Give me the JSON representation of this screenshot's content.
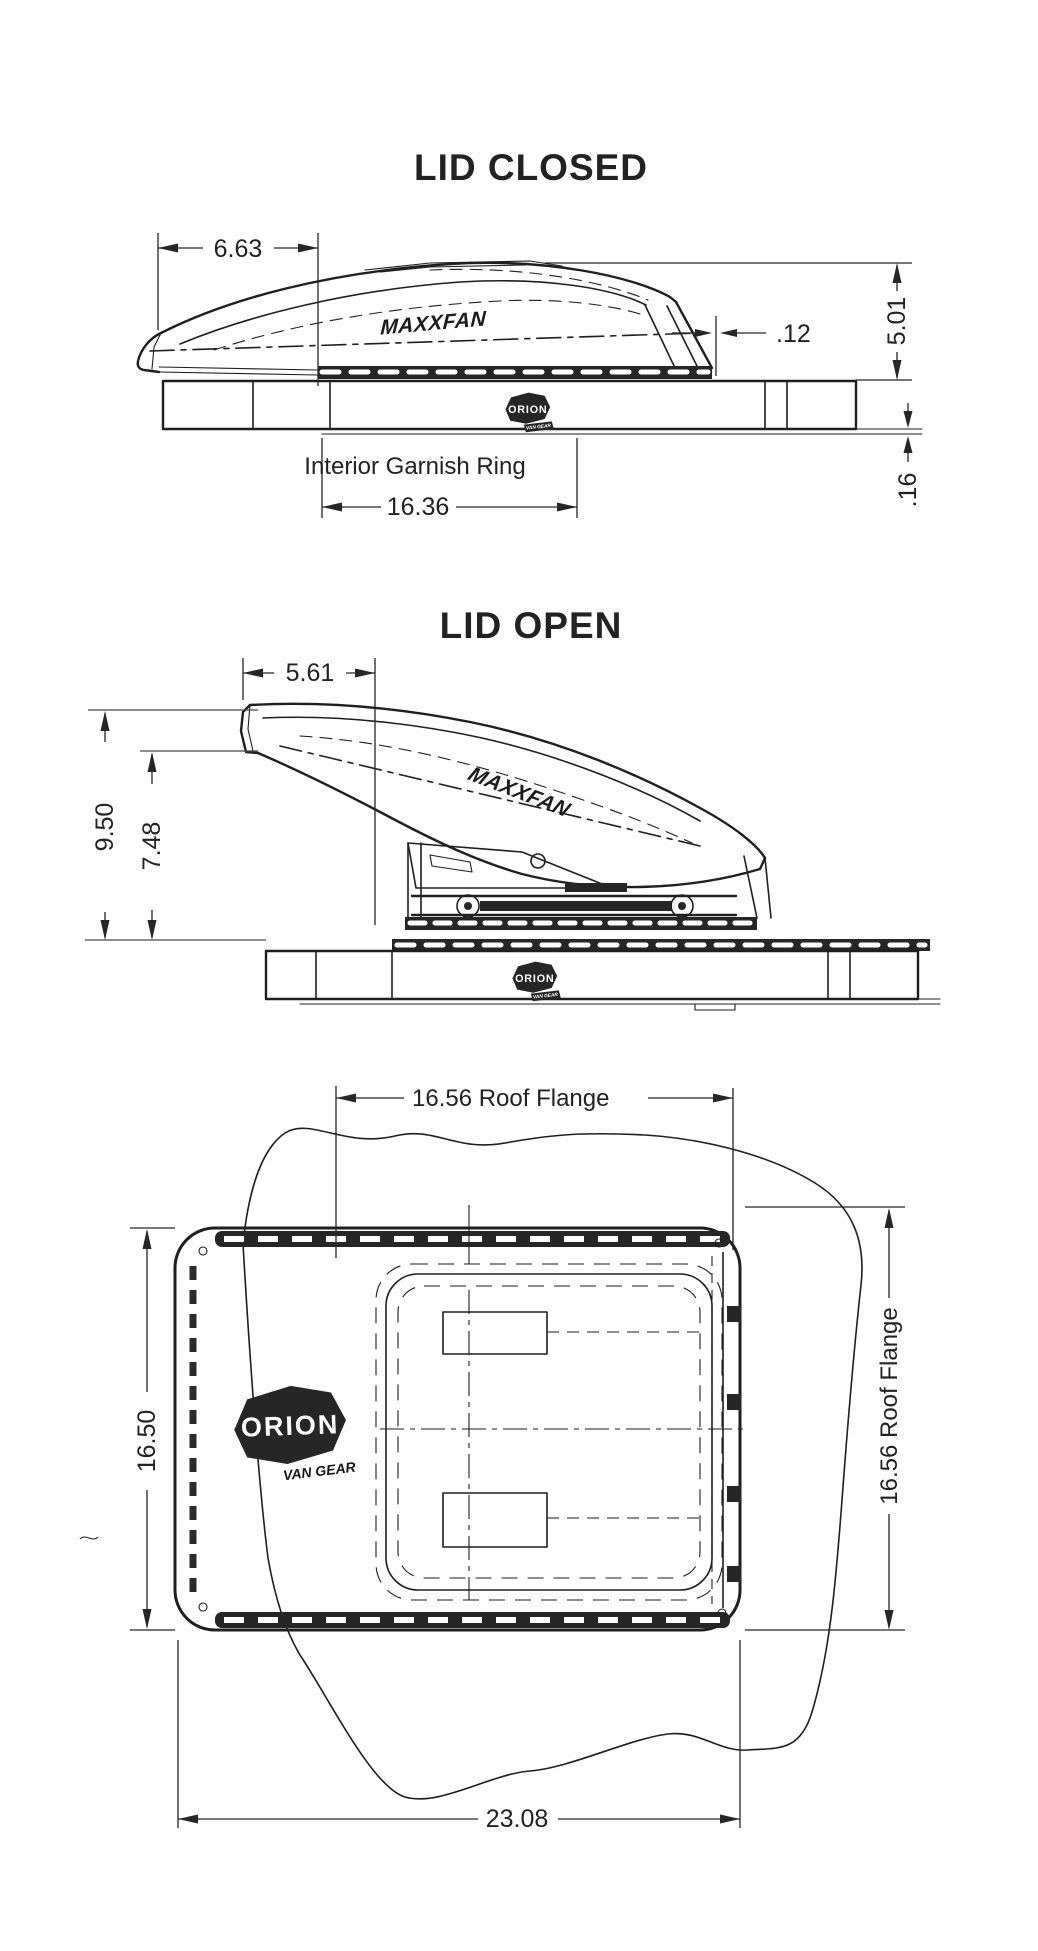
{
  "colors": {
    "ink": "#1f1f1f",
    "paper": "#fefefe"
  },
  "lid_closed": {
    "title": "LID CLOSED",
    "dim_front_width": "6.63",
    "dim_rear_gap": ".12",
    "dim_height": "5.01",
    "dim_flange_thickness": ".16",
    "garnish_label": "Interior Garnish Ring",
    "dim_garnish_width": "16.36",
    "maxxfan": "MAXXFAN",
    "orion": "ORION",
    "orion_sub": "VAN GEAR"
  },
  "lid_open": {
    "title": "LID OPEN",
    "dim_front_offset": "5.61",
    "dim_total_height": "9.50",
    "dim_lid_height": "7.48",
    "maxxfan": "MAXXFAN",
    "orion": "ORION",
    "orion_sub": "VAN GEAR"
  },
  "top_view": {
    "dim_flange_width_top": "16.56 Roof Flange",
    "dim_body_depth": "16.50",
    "dim_flange_depth_right": "16.56 Roof Flange",
    "dim_overall_width": "23.08",
    "orion": "ORION",
    "orion_sub": "VAN GEAR"
  }
}
